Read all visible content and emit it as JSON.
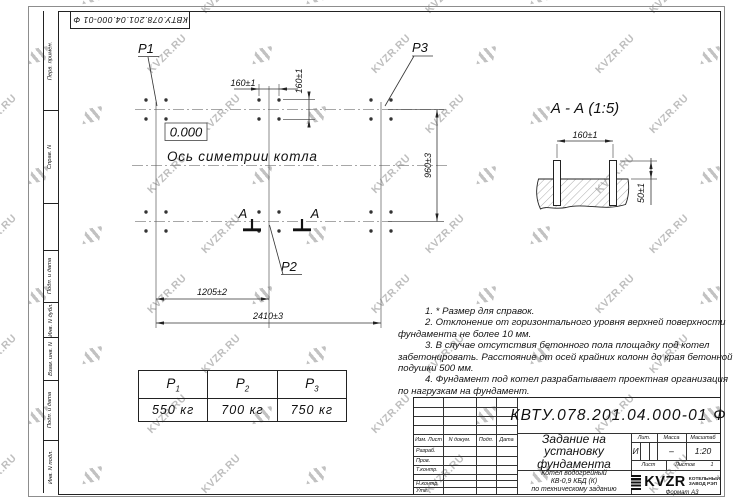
{
  "sheet": {
    "doc_number": "КВТУ.078.201.04.000-01 Ф",
    "format_label": "Формат А3"
  },
  "watermark": {
    "text": "KVZR.RU"
  },
  "sidebar": {
    "labels": [
      "Перв. примен.",
      "Справ. N",
      "Подп. и дата",
      "Инв. N дубл.",
      "Взам. инв. N",
      "Подп. и дата",
      "Инв. N подл."
    ]
  },
  "plan": {
    "level_mark": "0.000",
    "axis_label": "Ось симетрии котла",
    "labels": {
      "p1": "P1",
      "p2": "P2",
      "p3": "P3"
    },
    "section_letter": "А",
    "dims": {
      "d160h": "160±1",
      "d160v": "160±1",
      "d960": "960±3",
      "d1205": "1205±2",
      "d2410": "2410±3"
    }
  },
  "section_view": {
    "title": "А - А (1:5)",
    "d160": "160±1",
    "d50": "50±1"
  },
  "notes": {
    "lines": [
      "1. * Размер для справок.",
      "2. Отклонение от горизонтального уровня верхней поверхности",
      "фундамента не более 10 мм.",
      "3. В случае отсутствия бетонного пола площадку под котел",
      "забетонировать. Расстояние от осей крайних колонн до края бетонной",
      "подушки 500 мм.",
      "4. Фундамент под котел разрабатывает проектная организация",
      "по нагрузкам на фундамент."
    ]
  },
  "weights_table": {
    "headers": [
      {
        "letter": "Р",
        "sub": "1"
      },
      {
        "letter": "Р",
        "sub": "2"
      },
      {
        "letter": "Р",
        "sub": "3"
      }
    ],
    "values": [
      "550 кг",
      "700 кг",
      "750 кг"
    ]
  },
  "title_block": {
    "doc_number": "КВТУ.078.201.04.000-01 Ф",
    "title_lines": [
      "Задание на",
      "установку",
      "фундамента"
    ],
    "subtitle_lines": [
      "Котел водогрейный",
      "КВ-0,9 КБД (К)",
      "по техническому заданию"
    ],
    "col_headers": [
      "Изм. Лист",
      "N докум.",
      "Подп.",
      "Дата"
    ],
    "row_labels": [
      "Разраб.",
      "Пров.",
      "Т.контр.",
      "Н.контр.",
      "Утв."
    ],
    "lit_label": "Лит.",
    "mass_label": "Масса",
    "scale_label": "Масштаб",
    "lit_value": "И",
    "mass_value": "–",
    "scale_value": "1:20",
    "sheet_label": "Лист",
    "sheets_label": "Листов",
    "sheets_value": "1",
    "logo_text": "KVZR",
    "logo_caption": [
      "КОТЕЛЬНЫЙ",
      "ЗАВОД РЭП"
    ]
  }
}
